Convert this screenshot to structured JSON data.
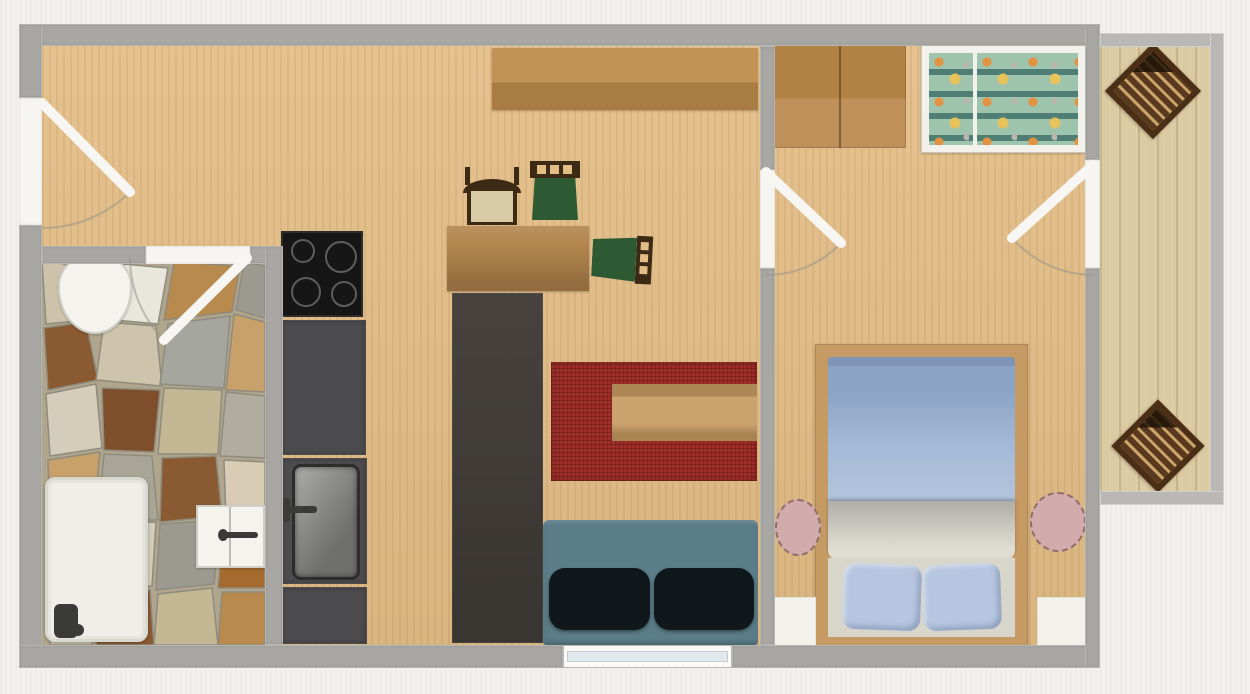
{
  "meta": {
    "title": "Apartment 2D floor plan",
    "view": "top-down architectural plan, no visible text labels"
  },
  "rooms": [
    {
      "id": "hall-living-kitchen",
      "label": "Entrance / kitchen / living room",
      "floor": "light wood"
    },
    {
      "id": "bathroom",
      "label": "Bathroom",
      "floor": "natural stone mosaic"
    },
    {
      "id": "bedroom",
      "label": "Bedroom",
      "floor": "light wood"
    },
    {
      "id": "balcony",
      "label": "Balcony",
      "floor": "wood planks"
    }
  ],
  "doors": [
    {
      "id": "entrance-door",
      "wall": "left outer wall",
      "swing": "into hall"
    },
    {
      "id": "bathroom-door",
      "wall": "bathroom top wall",
      "swing": "into bathroom"
    },
    {
      "id": "bedroom-door",
      "wall": "living/bedroom divider",
      "swing": "into bedroom"
    },
    {
      "id": "balcony-door",
      "wall": "bedroom right wall",
      "swing": "into bedroom"
    }
  ],
  "windows": [
    {
      "id": "living-window",
      "wall": "bottom outer wall, under sofa"
    }
  ],
  "objects": [
    {
      "id": "toilet",
      "room": "bathroom"
    },
    {
      "id": "bathtub",
      "room": "bathroom"
    },
    {
      "id": "washbasin-cabinet",
      "room": "bathroom"
    },
    {
      "id": "cooktop-4-burners",
      "room": "kitchen"
    },
    {
      "id": "kitchen-counter-upper",
      "room": "kitchen"
    },
    {
      "id": "kitchen-sink-unit",
      "room": "kitchen"
    },
    {
      "id": "kitchen-counter-lower",
      "room": "kitchen"
    },
    {
      "id": "tall-cabinet-column",
      "room": "living"
    },
    {
      "id": "wall-shelf-sideboard",
      "room": "living"
    },
    {
      "id": "desk",
      "room": "living"
    },
    {
      "id": "chair-tan-seat",
      "room": "living"
    },
    {
      "id": "chair-green-seat-1",
      "room": "living"
    },
    {
      "id": "chair-green-seat-2",
      "room": "living"
    },
    {
      "id": "red-rug",
      "room": "living"
    },
    {
      "id": "coffee-table",
      "room": "living"
    },
    {
      "id": "sofa-teal-2-cushions",
      "room": "living"
    },
    {
      "id": "wardrobe-2-door",
      "room": "bedroom"
    },
    {
      "id": "crib-patterned-bedding",
      "room": "bedroom"
    },
    {
      "id": "double-bed-blue-duvet-2-pillows",
      "room": "bedroom"
    },
    {
      "id": "round-nightstand-left",
      "room": "bedroom"
    },
    {
      "id": "round-nightstand-right",
      "room": "bedroom"
    },
    {
      "id": "white-floor-panel-left",
      "room": "bedroom"
    },
    {
      "id": "white-floor-panel-right",
      "room": "bedroom"
    },
    {
      "id": "slatted-deck-chair-top",
      "room": "balcony"
    },
    {
      "id": "slatted-deck-chair-bottom",
      "room": "balcony"
    }
  ],
  "palette": {
    "bg": "#f2f1ef",
    "wall": "#a8a7a3",
    "wallLight": "#b9b8b4",
    "doorwayWhite": "#f6f5f1",
    "floorWood": "#e3bd86",
    "floorGrain": "rgba(140,95,40,0.10)",
    "floorBalcony": "#dccaa2",
    "counter": "#4c4b4d",
    "cooktop": "#161616",
    "burnerRing": "#6f6f6d",
    "cabinetTall": "#47423e",
    "sinkSteel1": "#ababa9",
    "sinkSteel2": "#6f6f6d",
    "shelfWood1": "#c29355",
    "shelfWood2": "#a87c42",
    "desk": "#b3854e",
    "chairFrame": "#3c2a14",
    "chairSeatGreen": "#2e5a33",
    "chairSeatTan": "#d8cba5",
    "rug": "#a02e28",
    "coffeeTable": "#c59a61",
    "sofa": "#5a7d88",
    "sofaCushion": "#10181c",
    "wardrobe1": "#b28144",
    "wardrobe2": "#bf9059",
    "cribFrame": "#f2f1ec",
    "cribMint": "#9ec4ae",
    "cribStripe": "#4f7f74",
    "cribOrange": "#e3923f",
    "cribYellow": "#e7c35c",
    "bedFrame": "#c69a63",
    "duvet": "#a3b9d6",
    "duvetDark": "#8ba3c4",
    "blanket1": "#b0aea6",
    "blanket2": "#dedcd3",
    "bedBase": "#d8d5ca",
    "pillowBlue": "#b6c6e0",
    "nightstand": "#d2abac",
    "panelWhite": "#f2f1ea",
    "tubWhite": "#efeee8",
    "porcelain": "#f4f3ee",
    "fixtureDark": "#3a3a38",
    "balconyChair1": "#5a3a1e",
    "balconyChair2": "#c9a36a",
    "windowGlass": "#dfe9ee",
    "stoneBase": "#b0a68d"
  }
}
